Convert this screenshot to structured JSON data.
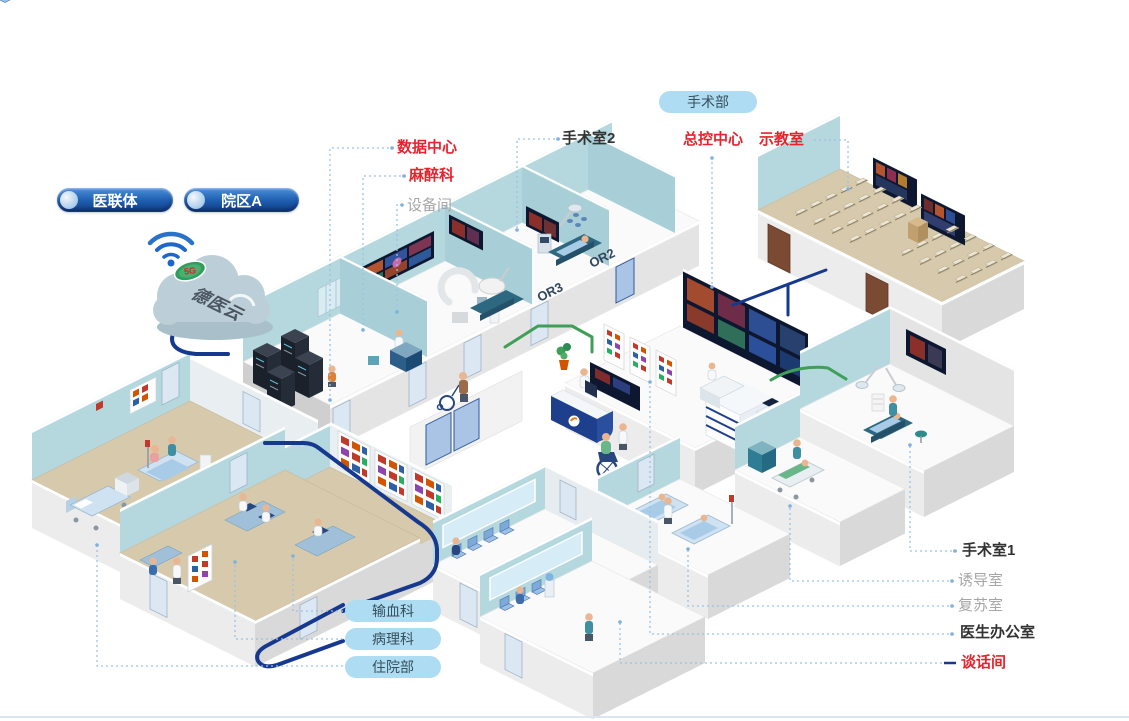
{
  "badges": {
    "alliance": "医联体",
    "campus": "院区A",
    "cloud": "德医云",
    "cloud_button": "5G",
    "department": "手术部"
  },
  "labels": {
    "or2": "手术室2",
    "data_center": "数据中心",
    "anesthesia": "麻醉科",
    "equipment": "设备间",
    "control": "总控中心",
    "classroom": "示教室",
    "or1": "手术室1",
    "induction": "诱导室",
    "recovery": "复苏室",
    "doctor_office": "医生办公室",
    "talk": "谈话间",
    "blood": "输血科",
    "pathology": "病理科",
    "inpatient": "住院部",
    "or2_tag": "OR2",
    "or3_tag": "OR3"
  },
  "colors": {
    "red": "#e8232e",
    "navy": "#16398f",
    "dark": "#333333",
    "gray": "#a6a6a6",
    "pill-blue": "#aedcf2",
    "teal-wall": "#b5d8df",
    "floor-tan": "#d6c9ac",
    "leader-blue": "#9cc2e5",
    "cable-green": "#3f9e57"
  }
}
